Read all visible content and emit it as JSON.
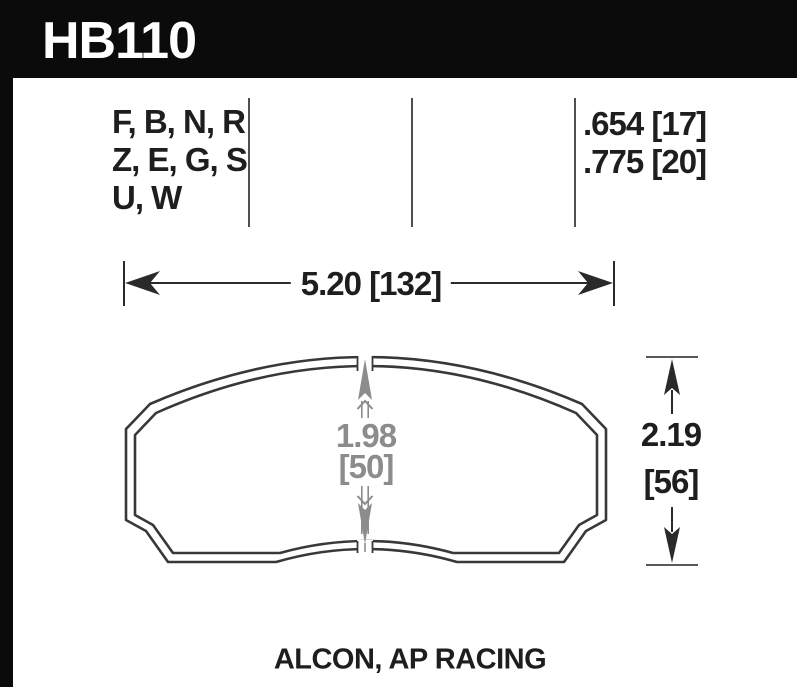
{
  "title": {
    "part_number": "HB110"
  },
  "compounds": {
    "rows": [
      "F, B, N, R",
      "Z, E, G, S",
      "U, W"
    ]
  },
  "pad_thickness": {
    "rows": [
      ".654 [17]",
      ".775 [20]"
    ]
  },
  "dimensions": {
    "width": "5.20 [132]",
    "friction_height_in": "1.98",
    "friction_height_mm": "[50]",
    "pad_height_in": "2.19",
    "pad_height_mm": "[56]"
  },
  "footer": {
    "applications": "ALCON, AP RACING"
  },
  "colors": {
    "header_bg": "#0b0b0b",
    "text_black": "#1e1e1e",
    "dimension_gray": "#8a8c8e",
    "outline_dark": "#383838",
    "divider_gray": "#4f4f51"
  }
}
